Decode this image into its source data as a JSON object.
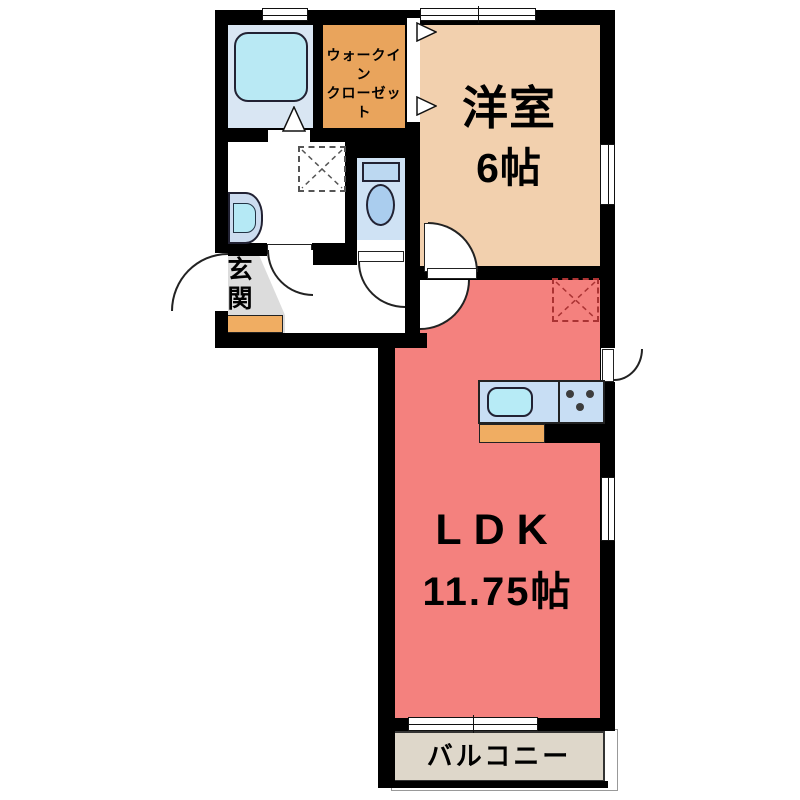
{
  "plan_title": "1LDK floor plan",
  "rooms": {
    "western_room": {
      "name": "洋室",
      "size": "6帖",
      "color": "#f2d0ae"
    },
    "ldk": {
      "name": "LDK",
      "size": "11.75帖",
      "color": "#f4817e"
    },
    "walk_in_closet": {
      "label_line1": "ウォークイン",
      "label_line2": "クローゼット",
      "color": "#e9a45c"
    },
    "entrance": {
      "name": "玄関",
      "floor_color": "#dcdcdc",
      "step_color": "#f0ad62"
    },
    "balcony": {
      "name": "バルコニー",
      "color": "#ded7ca"
    },
    "bathroom": {
      "floor_color": "#d9e6f3"
    },
    "toilet_room": {
      "floor_color": "#cfe2f4"
    },
    "washroom": {
      "floor_color": "#ffffff"
    },
    "hallway": {
      "floor_color": "#ffffff"
    }
  },
  "fixtures": {
    "bathtub": {
      "icon": "bathtub-icon",
      "color": "#b9e9f4"
    },
    "washbasin": {
      "icon": "washbasin-icon",
      "body_color": "#ccdcef",
      "bowl_color": "#b5e9f5"
    },
    "toilet": {
      "icon": "toilet-icon",
      "tank_color": "#bcd8f1",
      "bowl_color": "#aacdee"
    },
    "kitchen_counter": {
      "icon": "kitchen-counter-icon",
      "color": "#c8def4"
    },
    "kitchen_sink": {
      "icon": "kitchen-sink-icon",
      "color": "#b7ebf6"
    },
    "stove_burners": {
      "icon": "stove-burners-icon",
      "color": "#3d3d3d"
    },
    "kitchen_cabinet": {
      "icon": "kitchen-cabinet-icon",
      "color": "#f0ad62"
    },
    "washing_machine_space": {
      "icon": "washing-machine-pad-icon",
      "dash_color": "#555555"
    },
    "refrigerator_space": {
      "icon": "refrigerator-pad-icon",
      "dash_color": "#aa3333"
    }
  },
  "colors": {
    "wall": "#000000",
    "background": "#ffffff",
    "door_arc": "#222222"
  }
}
